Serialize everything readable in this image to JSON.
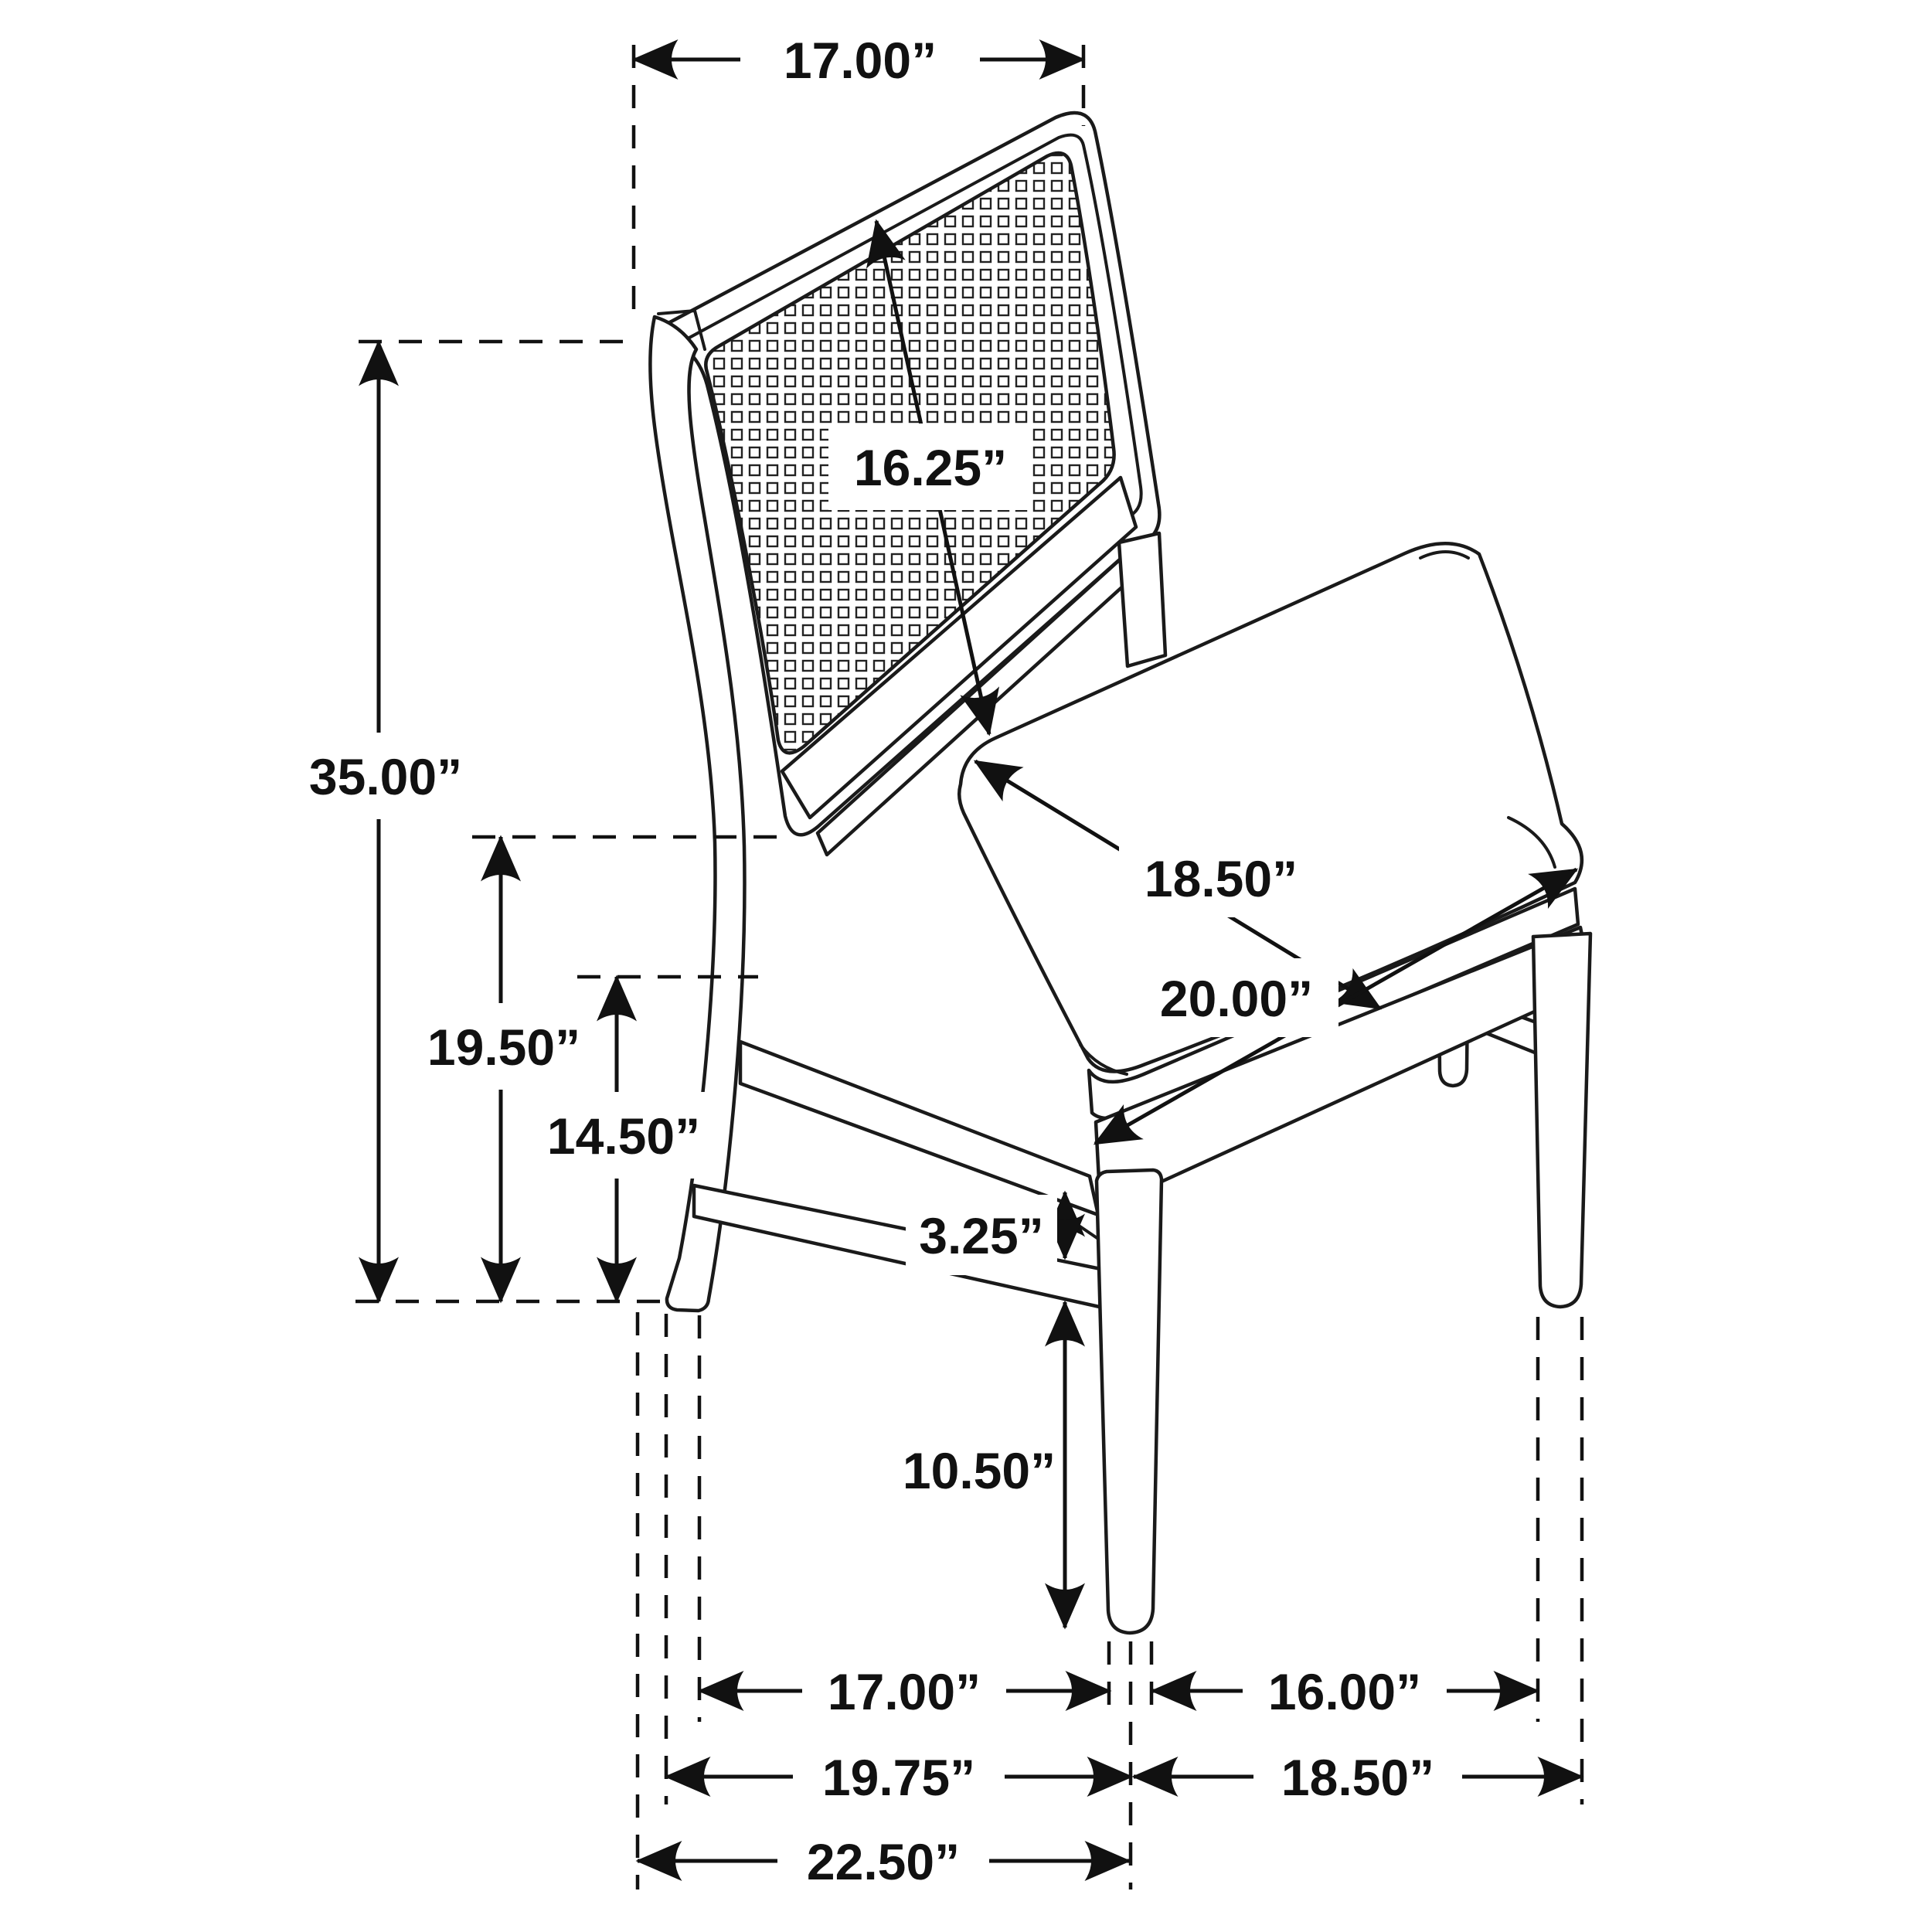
{
  "diagram": {
    "subject": "dining side chair with cane back - dimension drawing",
    "colors": {
      "line": "#1a1a1a",
      "background": "#ffffff"
    },
    "dims": {
      "top_back_width": "17.00”",
      "back_panel_height": "16.25”",
      "overall_height": "35.00”",
      "floor_to_seat_top": "19.50”",
      "floor_to_apron": "14.50”",
      "seat_depth": "18.50”",
      "seat_width": "20.00”",
      "apron_to_stretcher_gap": "3.25”",
      "stretcher_floor_clearance": "10.50”",
      "bottom_front_span_inner": "17.00”",
      "bottom_right_span_inner": "16.00”",
      "bottom_left_span_mid": "19.75”",
      "bottom_right_span_outer": "18.50”",
      "bottom_overall_depth": "22.50”"
    }
  }
}
